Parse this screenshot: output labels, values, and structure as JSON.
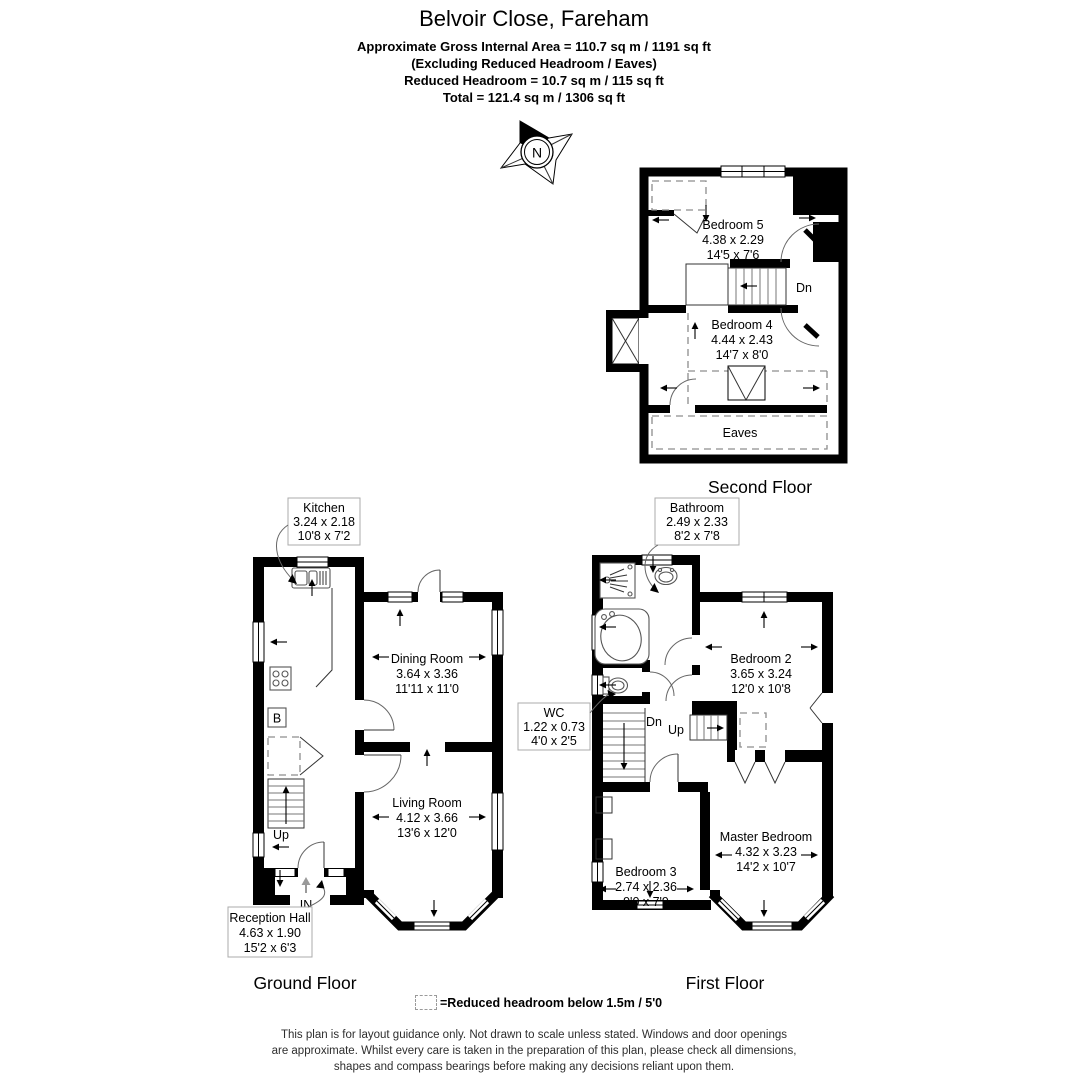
{
  "header": {
    "title": "Belvoir Close, Fareham",
    "area_line": "Approximate Gross Internal Area = 110.7 sq m / 1191 sq ft",
    "excluding_line": "(Excluding Reduced Headroom / Eaves)",
    "reduced_line": "Reduced Headroom = 10.7 sq m / 115 sq ft",
    "total_line": "Total = 121.4 sq m / 1306 sq ft"
  },
  "compass": {
    "north": "N"
  },
  "second_floor": {
    "title": "Second Floor",
    "bedroom5": {
      "name": "Bedroom 5",
      "metric": "4.38 x 2.29",
      "imperial": "14'5 x 7'6"
    },
    "bedroom4": {
      "name": "Bedroom 4",
      "metric": "4.44 x 2.43",
      "imperial": "14'7 x 8'0"
    },
    "eaves": "Eaves",
    "dn": "Dn"
  },
  "ground_floor": {
    "title": "Ground Floor",
    "kitchen": {
      "name": "Kitchen",
      "metric": "3.24 x 2.18",
      "imperial": "10'8 x 7'2"
    },
    "dining_room": {
      "name": "Dining Room",
      "metric": "3.64 x 3.36",
      "imperial": "11'11 x 11'0"
    },
    "living_room": {
      "name": "Living Room",
      "metric": "4.12 x 3.66",
      "imperial": "13'6 x 12'0"
    },
    "reception_hall": {
      "name": "Reception Hall",
      "metric": "4.63 x 1.90",
      "imperial": "15'2 x 6'3"
    },
    "boiler": "B",
    "up": "Up",
    "entrance": "IN"
  },
  "first_floor": {
    "title": "First Floor",
    "bathroom": {
      "name": "Bathroom",
      "metric": "2.49 x 2.33",
      "imperial": "8'2 x 7'8"
    },
    "wc": {
      "name": "WC",
      "metric": "1.22 x 0.73",
      "imperial": "4'0 x 2'5"
    },
    "bedroom2": {
      "name": "Bedroom 2",
      "metric": "3.65 x 3.24",
      "imperial": "12'0 x 10'8"
    },
    "bedroom3": {
      "name": "Bedroom 3",
      "metric": "2.74 x 2.36",
      "imperial": "9'0 x 7'9"
    },
    "master_bedroom": {
      "name": "Master Bedroom",
      "metric": "4.32 x 3.23",
      "imperial": "14'2 x 10'7"
    },
    "dn": "Dn",
    "up": "Up"
  },
  "legend": {
    "text": "=Reduced headroom below 1.5m / 5'0"
  },
  "disclaimer": {
    "line1": "This plan is for layout guidance only. Not drawn to scale unless stated. Windows and door openings",
    "line2": "are approximate. Whilst every care is taken in the preparation of this plan, please check all dimensions,",
    "line3": "shapes and compass bearings before making any decisions reliant upon them."
  }
}
